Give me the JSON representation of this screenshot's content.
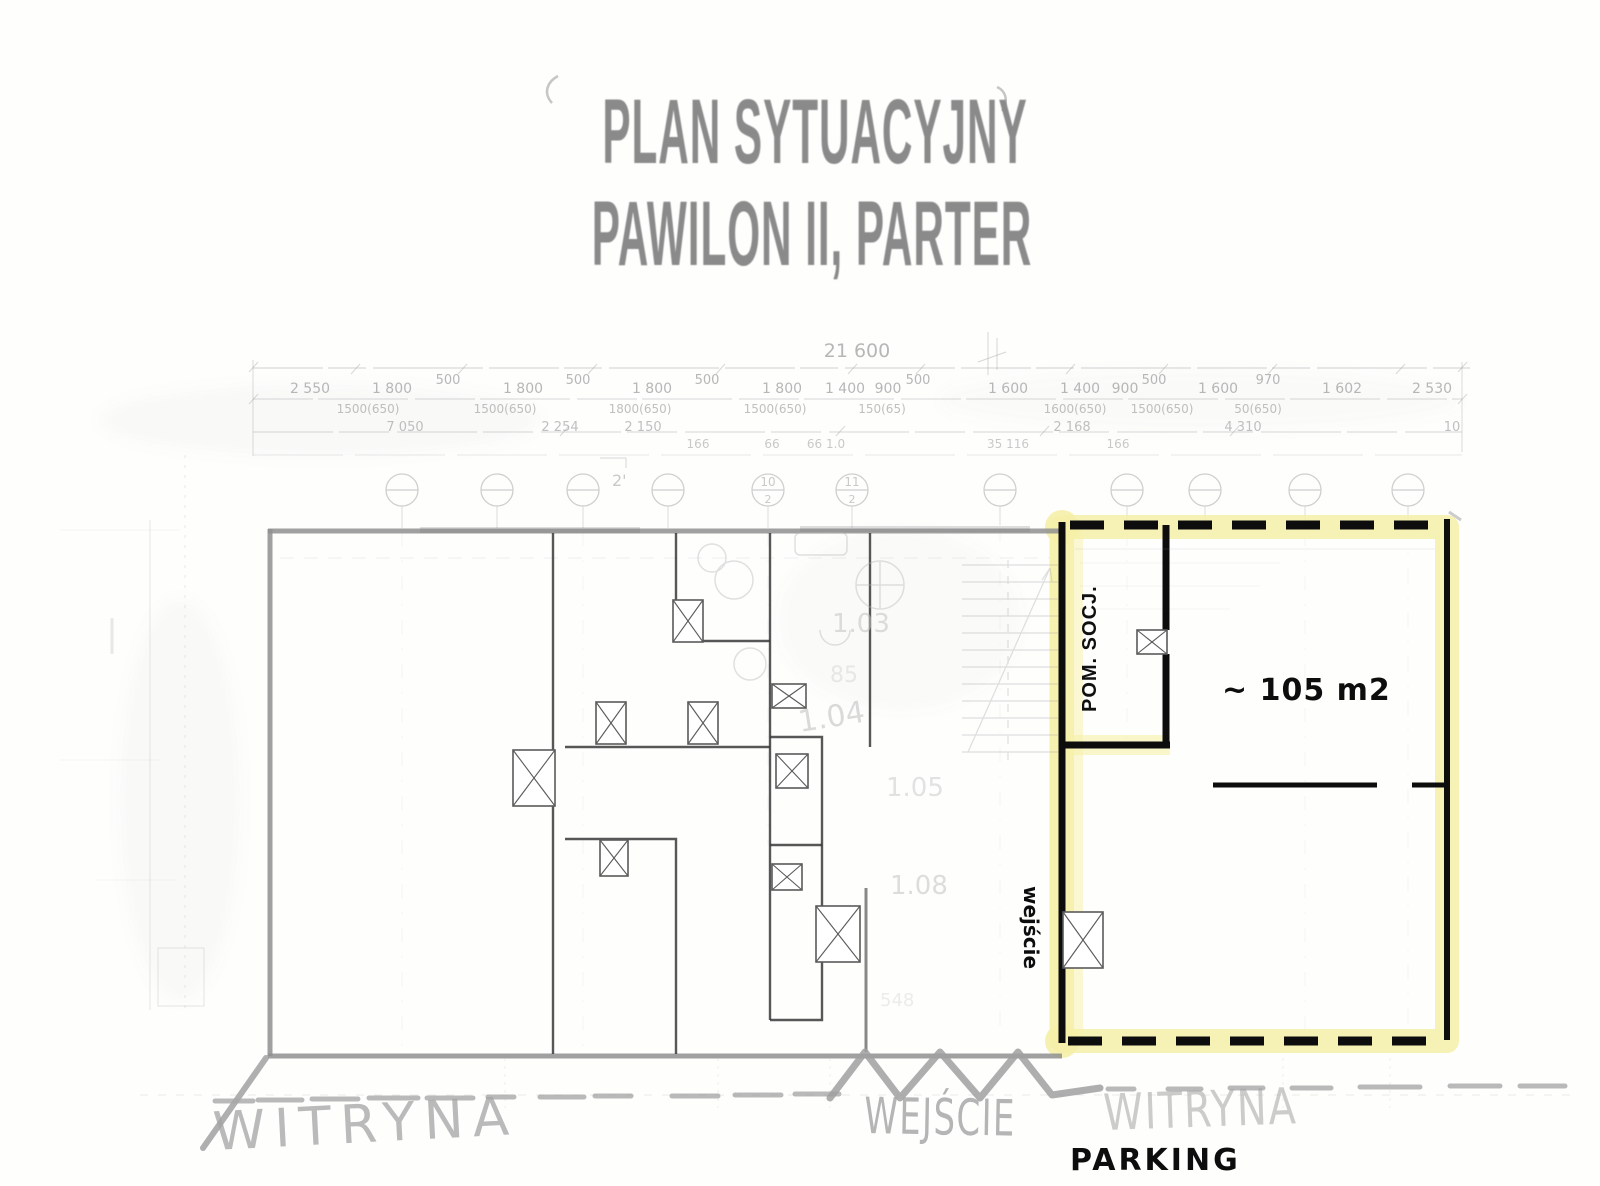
{
  "title": {
    "line1": "PLAN SYTUACYJNY",
    "line2": "PAWILON II, PARTER"
  },
  "dims": {
    "total": "21 600",
    "row1": [
      "2 550",
      "1 800",
      "500",
      "1 800",
      "500",
      "1 800",
      "500",
      "1 800",
      "1 400",
      "900",
      "500",
      "1 600",
      "1 400",
      "900",
      "500",
      "1 600",
      "970",
      "1 602",
      "2 530"
    ],
    "row2": [
      "1500(650)",
      "1500(650)",
      "1800(650)",
      "1500(650)",
      "150(65)",
      "1600(650)",
      "1500(650)",
      "50(650)"
    ],
    "row3": [
      "7 050",
      "2 254",
      "2 150",
      "2 168",
      "4 310",
      "10"
    ],
    "row4": [
      "166",
      "66",
      "66 1.0",
      "35 116",
      "166"
    ],
    "break_note": "2'"
  },
  "grid": {
    "den": "2",
    "circles": [
      "",
      "",
      "",
      "",
      "10",
      "11",
      "",
      "",
      "",
      "",
      ""
    ]
  },
  "rooms": {
    "r103": "1.03",
    "r104": "1.04",
    "r105": "1.05",
    "r108": "1.08",
    "n85": "85",
    "n548": "548"
  },
  "highlight": {
    "pom_socj": "POM. SOCJ.",
    "area": "~ 105 m2",
    "wejscie": "wejście"
  },
  "bottom": {
    "witryna_left": "WITRYNA",
    "wejscie": "WEJŚCIE",
    "witryna_right": "WITRYNA",
    "parking": "PARKING"
  },
  "colors": {
    "highlight_yellow": "#f5f0a8",
    "wall_black": "#0d0d0d",
    "scan_gray": "#9c9c9c",
    "faint_gray": "#bbbbbb",
    "title_gray": "#8a8a8a"
  }
}
